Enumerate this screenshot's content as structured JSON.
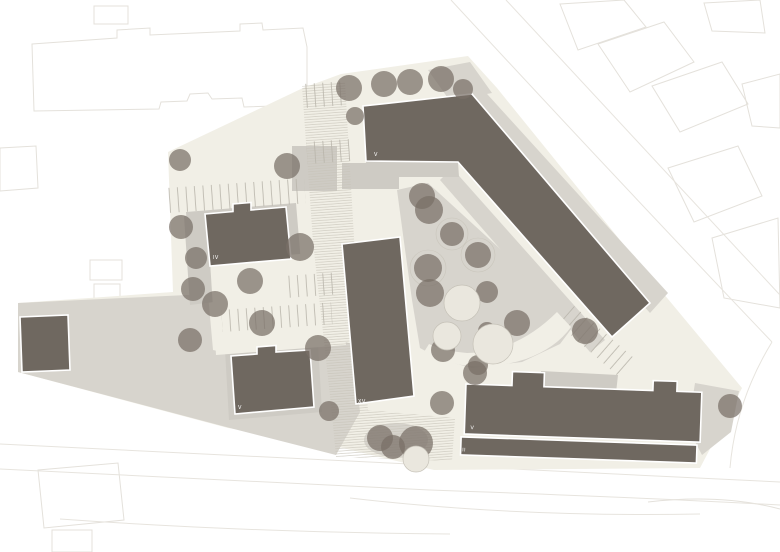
{
  "plan": {
    "kind": "architectural-site-plan",
    "building_labels": [
      {
        "id": "north-slab",
        "label": "V"
      },
      {
        "id": "west-villa",
        "label": "IV"
      },
      {
        "id": "southwest-villa",
        "label": "V"
      },
      {
        "id": "tower",
        "label": "XV"
      },
      {
        "id": "south-slab",
        "label": "V"
      },
      {
        "id": "south-wing",
        "label": "II"
      }
    ]
  },
  "colors": {
    "background": "#ffffff",
    "site": "#f1efe6",
    "paved": "#d7d4cd",
    "paved_light": "#cecbc4",
    "building": "#6f6860",
    "tree": "#786f66",
    "hatch_line": "#c7c3b8",
    "stall_line": "#b8b4aa",
    "context_line": "#e4e1db",
    "label": "#ffffff"
  }
}
